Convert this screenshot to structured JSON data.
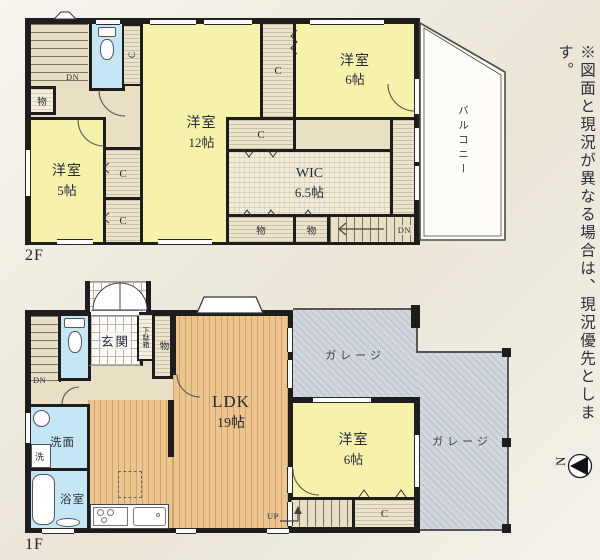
{
  "common": {
    "closet": "C",
    "storage": "物",
    "down": "DN",
    "up": "UP"
  },
  "f2": {
    "floor_label": "2F",
    "room12_name": "洋室",
    "room12_size": "12帖",
    "room6_name": "洋室",
    "room6_size": "6帖",
    "room5_name": "洋室",
    "room5_size": "5帖",
    "wic_name": "WIC",
    "wic_size": "6.5帖",
    "balcony": "バルコニー"
  },
  "f1": {
    "floor_label": "1F",
    "ldk_name": "LDK",
    "ldk_size": "19帖",
    "room6_name": "洋室",
    "room6_size": "6帖",
    "entrance": "玄関",
    "shoe_box": "下駄箱",
    "washroom": "洗面",
    "washer": "洗",
    "bathroom": "浴室",
    "garage_upper": "ガレージ",
    "garage_right": "ガレージ"
  },
  "notes": {
    "disclaimer": "※図面と現況が異なる場合は、現況優先とします。",
    "north_label": "N"
  }
}
